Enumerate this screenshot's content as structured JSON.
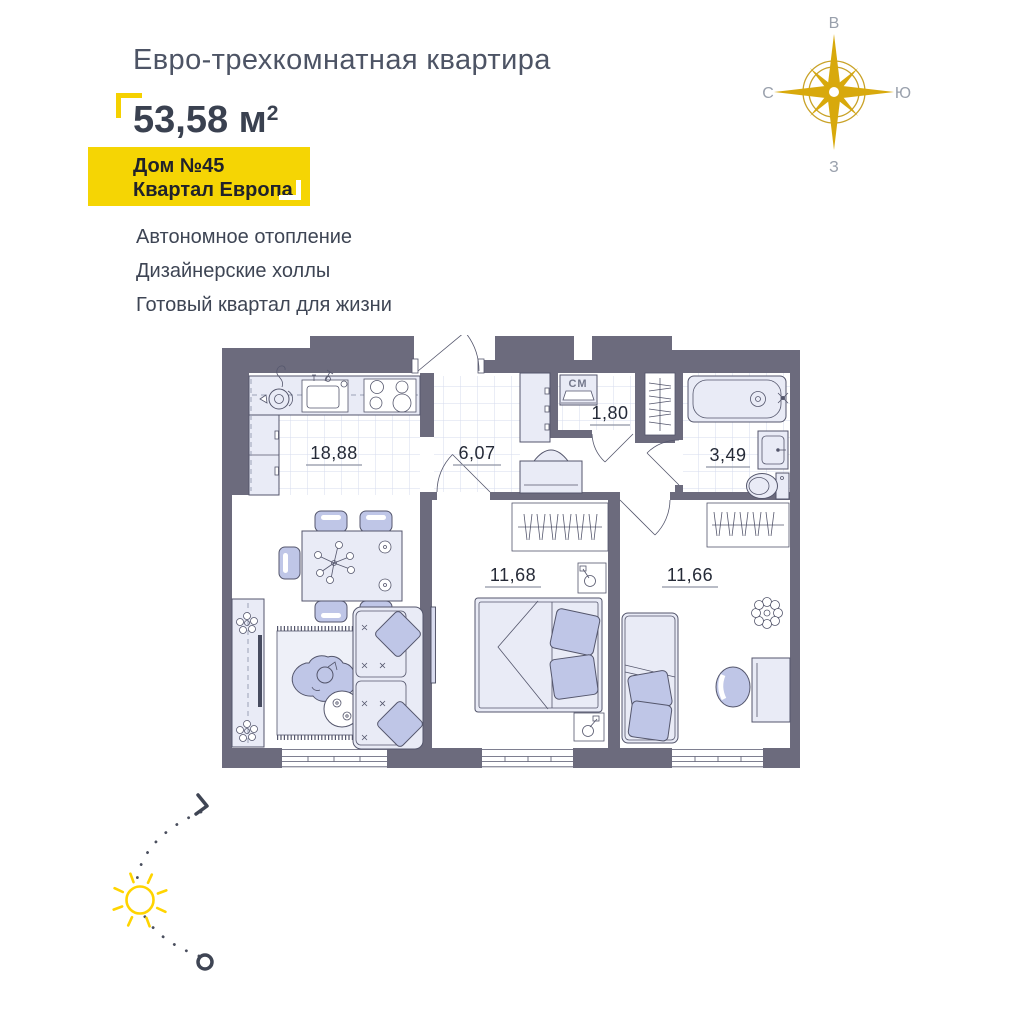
{
  "header": {
    "title": "Евро-трехкомнатная квартира",
    "area_value": "53,58 м",
    "area_sup": "2",
    "badge": {
      "line1": "Дом №45",
      "line2": "Квартал Европа"
    }
  },
  "features": {
    "items": [
      "Автономное отопление",
      "Дизайнерские холлы",
      "Готовый квартал для жизни"
    ]
  },
  "compass": {
    "top": "В",
    "right": "Ю",
    "bottom": "З",
    "left": "С"
  },
  "plan": {
    "rooms": {
      "kitchen_living": {
        "name": "kitchen-living-room",
        "area": "18,88"
      },
      "hallway": {
        "name": "hallway",
        "area": "6,07"
      },
      "laundry": {
        "name": "laundry-closet",
        "area": "1,80"
      },
      "bathroom": {
        "name": "bathroom",
        "area": "3,49"
      },
      "bedroom1": {
        "name": "bedroom-1",
        "area": "11,68"
      },
      "bedroom2": {
        "name": "bedroom-2",
        "area": "11,66"
      }
    },
    "washer_label": "СМ"
  },
  "colors": {
    "accent_yellow": "#F5D504",
    "bracket_yellow": "#F5D100",
    "wall": "#6C6B7D",
    "furniture_light": "#E9EBF6",
    "furniture_accent": "#BFC6E7",
    "compass_gold": "#D8A90C",
    "sun_yellow": "#FFD400",
    "text_dark": "#3A4150",
    "text_gray": "#4D5465"
  }
}
